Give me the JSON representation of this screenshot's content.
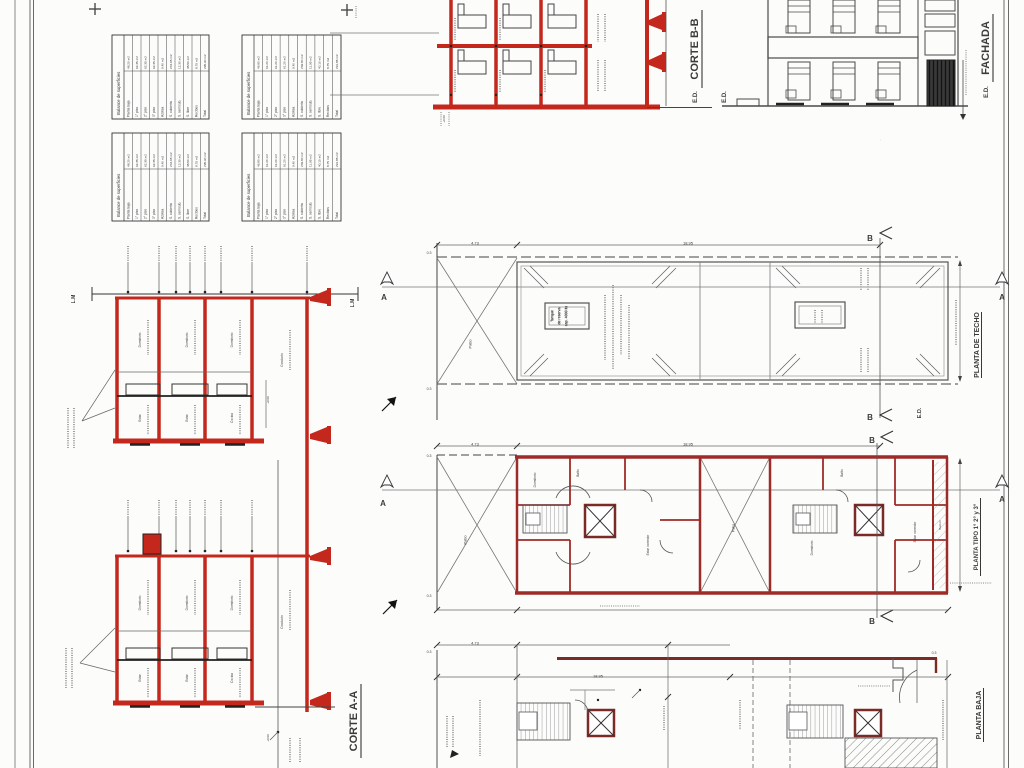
{
  "palette": {
    "red": "#c4281d",
    "maroon": "#7c2a26",
    "ink": "#3b3b3b",
    "gray": "#6e6e6e"
  },
  "titles": {
    "corte_bb": "CORTE B-B",
    "corte_aa": "CORTE A-A",
    "fachada": "FACHADA",
    "planta_techo": "PLANTA DE TECHO",
    "planta_tipo": "PLANTA TIPO 1° 2° y 3°",
    "planta_baja": "PLANTA BAJA"
  },
  "tank_note": {
    "line1": "Tanque",
    "line2": "de reserva",
    "line3": "cap. 4000 lts"
  },
  "tables": {
    "items": [
      {
        "x": 112,
        "y": 35,
        "w": 97,
        "h": 84,
        "title": "Balance de superficies",
        "rows": [
          [
            "Planta baja",
            "48.20 m2"
          ],
          [
            "1° piso",
            "62.35 m2"
          ],
          [
            "2° piso",
            "62.35 m2"
          ],
          [
            "3° piso",
            "62.35 m2"
          ],
          [
            "Azotea",
            "9.40 m2"
          ],
          [
            "S. cubierta",
            "244.65 m2"
          ],
          [
            "S. semicub.",
            "12.30 m2"
          ],
          [
            "S. libre",
            "38.50 m2"
          ],
          [
            "Recibos",
            "8.75 m2"
          ],
          [
            "Total",
            "295.90 m2"
          ]
        ]
      },
      {
        "x": 242,
        "y": 35,
        "w": 99,
        "h": 84,
        "title": "Balance de superficies",
        "rows": [
          [
            "Planta baja",
            "46.80 m2"
          ],
          [
            "1° piso",
            "61.20 m2"
          ],
          [
            "2° piso",
            "61.20 m2"
          ],
          [
            "3° piso",
            "61.20 m2"
          ],
          [
            "Azotea",
            "9.40 m2"
          ],
          [
            "S. cubierta",
            "239.80 m2"
          ],
          [
            "S. semicub.",
            "11.95 m2"
          ],
          [
            "S. libre",
            "40.10 m2"
          ],
          [
            "Recibos",
            "8.75 m2"
          ],
          [
            "Total",
            "291.85 m2"
          ]
        ]
      },
      {
        "x": 112,
        "y": 133,
        "w": 97,
        "h": 88,
        "title": "Balance de superficies",
        "rows": [
          [
            "Planta baja",
            "48.20 m2"
          ],
          [
            "1° piso",
            "62.35 m2"
          ],
          [
            "2° piso",
            "62.35 m2"
          ],
          [
            "3° piso",
            "62.35 m2"
          ],
          [
            "Azotea",
            "9.40 m2"
          ],
          [
            "S. cubierta",
            "244.65 m2"
          ],
          [
            "S. semicub.",
            "12.30 m2"
          ],
          [
            "S. libre",
            "38.50 m2"
          ],
          [
            "Recibos",
            "8.75 m2"
          ],
          [
            "Total",
            "295.90 m2"
          ]
        ]
      },
      {
        "x": 242,
        "y": 133,
        "w": 99,
        "h": 88,
        "title": "Balance de superficies",
        "rows": [
          [
            "Planta baja",
            "46.80 m2"
          ],
          [
            "1° piso",
            "61.20 m2"
          ],
          [
            "2° piso",
            "61.20 m2"
          ],
          [
            "3° piso",
            "61.20 m2"
          ],
          [
            "Azotea",
            "9.40 m2"
          ],
          [
            "S. cubierta",
            "239.80 m2"
          ],
          [
            "S. semicub.",
            "11.95 m2"
          ],
          [
            "S. libre",
            "40.10 m2"
          ],
          [
            "Recibos",
            "8.75 m2"
          ],
          [
            "Total",
            "291.85 m2"
          ]
        ]
      }
    ]
  },
  "annotations": [
    {
      "x": 73,
      "y": 299,
      "t": "L.M",
      "s": 5,
      "b": 1
    },
    {
      "x": 352,
      "y": 303,
      "t": "L.M",
      "s": 5,
      "b": 1
    },
    {
      "x": 695,
      "y": 97,
      "t": "E.D.",
      "s": 6,
      "b": 1
    },
    {
      "x": 724,
      "y": 97,
      "t": "E.D.",
      "s": 6,
      "b": 1
    },
    {
      "x": 986,
      "y": 92,
      "t": "E.D.",
      "s": 6,
      "b": 1
    },
    {
      "x": 919,
      "y": 413,
      "t": "E.D.",
      "s": 5.5,
      "b": 1
    },
    {
      "x": 384,
      "y": 297,
      "t": "A",
      "s": 8,
      "r": 0,
      "b": 1
    },
    {
      "x": 1002,
      "y": 297,
      "t": "A",
      "s": 8,
      "r": 0,
      "b": 1
    },
    {
      "x": 383,
      "y": 503,
      "t": "A",
      "s": 8,
      "r": 0,
      "b": 1
    },
    {
      "x": 1002,
      "y": 499,
      "t": "A",
      "s": 8,
      "r": 0,
      "b": 1
    },
    {
      "x": 870,
      "y": 238,
      "t": "B",
      "s": 8,
      "r": 0,
      "b": 1
    },
    {
      "x": 870,
      "y": 417,
      "t": "B",
      "s": 8,
      "r": 0,
      "b": 1
    },
    {
      "x": 872,
      "y": 440,
      "t": "B",
      "s": 8,
      "r": 0,
      "b": 1
    },
    {
      "x": 872,
      "y": 621,
      "t": "B",
      "s": 8,
      "r": 0,
      "b": 1
    },
    {
      "x": 429,
      "y": 253,
      "t": "0.3",
      "s": 3.5,
      "r": 0
    },
    {
      "x": 429,
      "y": 389,
      "t": "0.3",
      "s": 3.5,
      "r": 0
    },
    {
      "x": 429,
      "y": 456,
      "t": "0.3",
      "s": 3.5,
      "r": 0
    },
    {
      "x": 429,
      "y": 596,
      "t": "0.3",
      "s": 3.5,
      "r": 0
    },
    {
      "x": 429,
      "y": 652,
      "t": "0.3",
      "s": 3.5,
      "r": 0
    },
    {
      "x": 934,
      "y": 653,
      "t": "0.3",
      "s": 3.5,
      "r": 0
    },
    {
      "x": 475,
      "y": 243,
      "t": "4.73",
      "s": 4,
      "r": 0
    },
    {
      "x": 475,
      "y": 444,
      "t": "4.73",
      "s": 4,
      "r": 0
    },
    {
      "x": 475,
      "y": 643,
      "t": "4.73",
      "s": 4,
      "r": 0
    },
    {
      "x": 688,
      "y": 243,
      "t": "18.95",
      "s": 4,
      "r": 0
    },
    {
      "x": 688,
      "y": 444,
      "t": "18.95",
      "s": 4,
      "r": 0
    },
    {
      "x": 598,
      "y": 676,
      "t": "18.95",
      "s": 4,
      "r": 0
    },
    {
      "x": 552,
      "y": 316,
      "t": "Tanque",
      "s": 3.6
    },
    {
      "x": 559,
      "y": 316,
      "t": "de reserva",
      "s": 3.6
    },
    {
      "x": 566,
      "y": 316,
      "t": "cap. 4000 lts",
      "s": 3.6
    },
    {
      "x": 470,
      "y": 344,
      "t": "Patio",
      "s": 4,
      "c": "#777"
    },
    {
      "x": 465,
      "y": 540,
      "t": "Patio",
      "s": 4,
      "c": "#777"
    },
    {
      "x": 733,
      "y": 528,
      "t": "Patio",
      "s": 3.6,
      "c": "#777"
    },
    {
      "x": 535,
      "y": 480,
      "t": "Dormitorio",
      "s": 3.2,
      "c": "#555"
    },
    {
      "x": 578,
      "y": 473,
      "t": "Baño",
      "s": 3.2,
      "c": "#555"
    },
    {
      "x": 648,
      "y": 545,
      "t": "Estar comedor",
      "s": 3.2,
      "c": "#555"
    },
    {
      "x": 812,
      "y": 548,
      "t": "Dormitorio",
      "s": 3.2,
      "c": "#555"
    },
    {
      "x": 842,
      "y": 473,
      "t": "Baño",
      "s": 3.2,
      "c": "#555"
    },
    {
      "x": 915,
      "y": 532,
      "t": "Estar comedor",
      "s": 3.2,
      "c": "#555"
    },
    {
      "x": 940,
      "y": 525,
      "t": "Balcón",
      "s": 3,
      "c": "#555"
    },
    {
      "x": 140,
      "y": 340,
      "t": "Dormitorio",
      "s": 3.2,
      "c": "#555"
    },
    {
      "x": 187,
      "y": 340,
      "t": "Dormitorio",
      "s": 3.2,
      "c": "#555"
    },
    {
      "x": 232,
      "y": 340,
      "t": "Dormitorio",
      "s": 3.2,
      "c": "#555"
    },
    {
      "x": 282,
      "y": 360,
      "t": "Conducto",
      "s": 3.2,
      "c": "#555"
    },
    {
      "x": 140,
      "y": 418,
      "t": "Estar",
      "s": 3.2,
      "c": "#555"
    },
    {
      "x": 187,
      "y": 418,
      "t": "Estar",
      "s": 3.2,
      "c": "#555"
    },
    {
      "x": 232,
      "y": 418,
      "t": "Cocina",
      "s": 3.2,
      "c": "#555"
    },
    {
      "x": 140,
      "y": 603,
      "t": "Dormitorio",
      "s": 3.2,
      "c": "#555"
    },
    {
      "x": 187,
      "y": 603,
      "t": "Dormitorio",
      "s": 3.2,
      "c": "#555"
    },
    {
      "x": 232,
      "y": 603,
      "t": "Dormitorio",
      "s": 3.2,
      "c": "#555"
    },
    {
      "x": 282,
      "y": 622,
      "t": "Conducto",
      "s": 3.2,
      "c": "#555"
    },
    {
      "x": 140,
      "y": 678,
      "t": "Estar",
      "s": 3.2,
      "c": "#555"
    },
    {
      "x": 187,
      "y": 678,
      "t": "Estar",
      "s": 3.2,
      "c": "#555"
    },
    {
      "x": 232,
      "y": 678,
      "t": "Cocina",
      "s": 3.2,
      "c": "#555"
    },
    {
      "x": 444,
      "y": 119,
      "t": "+0.00",
      "s": 3,
      "c": "#555"
    },
    {
      "x": 268,
      "y": 400,
      "t": "+0.00",
      "s": 3,
      "c": "#555"
    },
    {
      "x": 268,
      "y": 738,
      "t": "+0.00",
      "s": 3,
      "c": "#555"
    }
  ]
}
